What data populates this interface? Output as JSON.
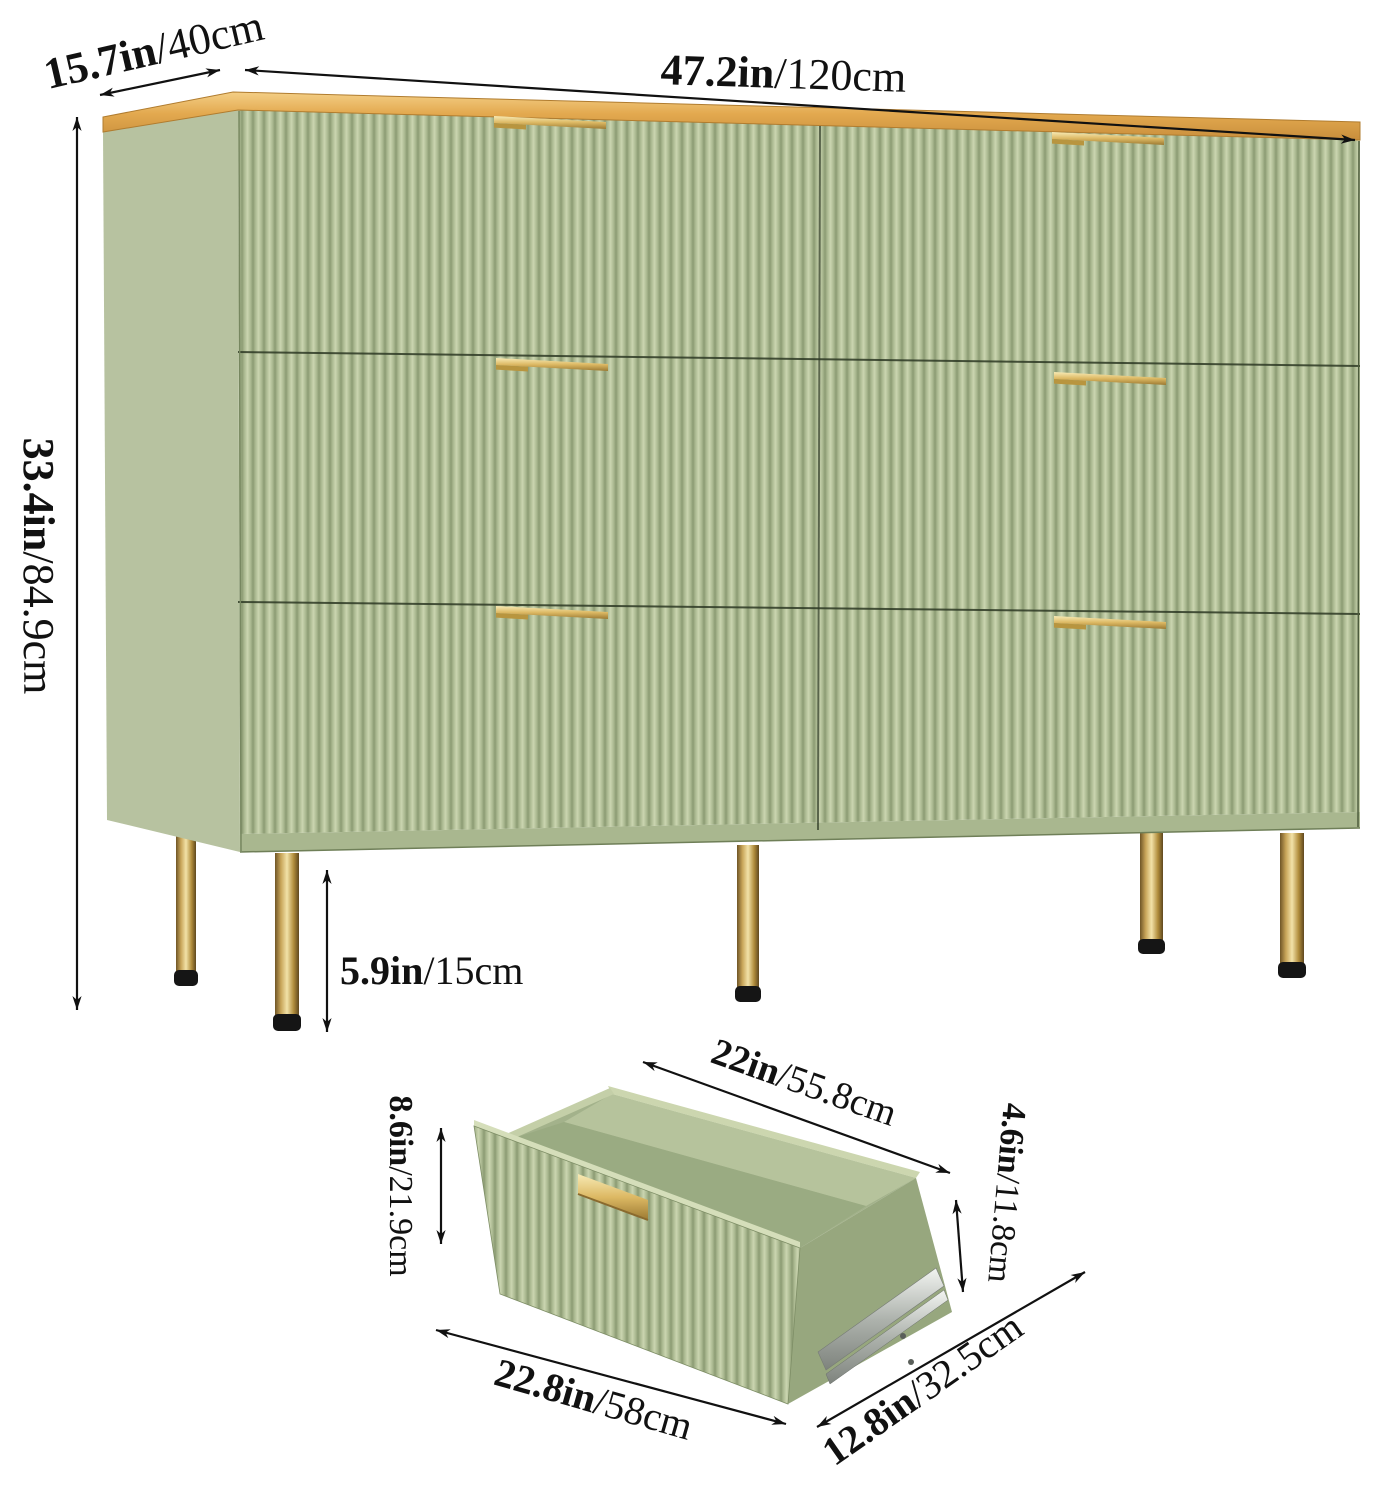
{
  "figure": {
    "kind": "product-dimension-diagram",
    "subject": "six-drawer fluted dresser with gold legs, gold bar handles and wood top, plus detail view of one open drawer"
  },
  "colors": {
    "background": "#ffffff",
    "flute_light": "#cbd5b0",
    "flute_mid": "#a9b78f",
    "flute_dark": "#8b9b73",
    "side_panel_green": "#b7c2a0",
    "base_green": "#a9b78f",
    "interior_green": "#a3b28b",
    "interior_back_green": "#b6c39c",
    "interior_floor_green": "#9aab82",
    "right_side_green": "#97a77e",
    "rim_green": "#ccd6af",
    "wood_light": "#f4cf86",
    "wood_dark": "#c98e3c",
    "gold_light": "#f7eab5",
    "gold_dark": "#9c7a32",
    "leg_foot_black": "#151515",
    "rail_silver": "#c9cdc8",
    "dimension_line": "#111111"
  },
  "labels": {
    "width": {
      "inches": "47.2in",
      "cm": "/120cm"
    },
    "depth": {
      "inches": "15.7in",
      "cm": "/40cm"
    },
    "height": {
      "inches": "33.4in",
      "cm": "/84.9cm"
    },
    "leg_height": {
      "inches": "5.9in",
      "cm": "/15cm"
    },
    "drawer_top_width": {
      "inches": "22in",
      "cm": "/55.8cm"
    },
    "drawer_front_height": {
      "inches": "8.6in",
      "cm": "/21.9cm"
    },
    "drawer_inner_height": {
      "inches": "4.6in",
      "cm": "/11.8cm"
    },
    "drawer_front_width": {
      "inches": "22.8in",
      "cm": "/58cm"
    },
    "drawer_depth": {
      "inches": "12.8in",
      "cm": "/32.5cm"
    }
  }
}
